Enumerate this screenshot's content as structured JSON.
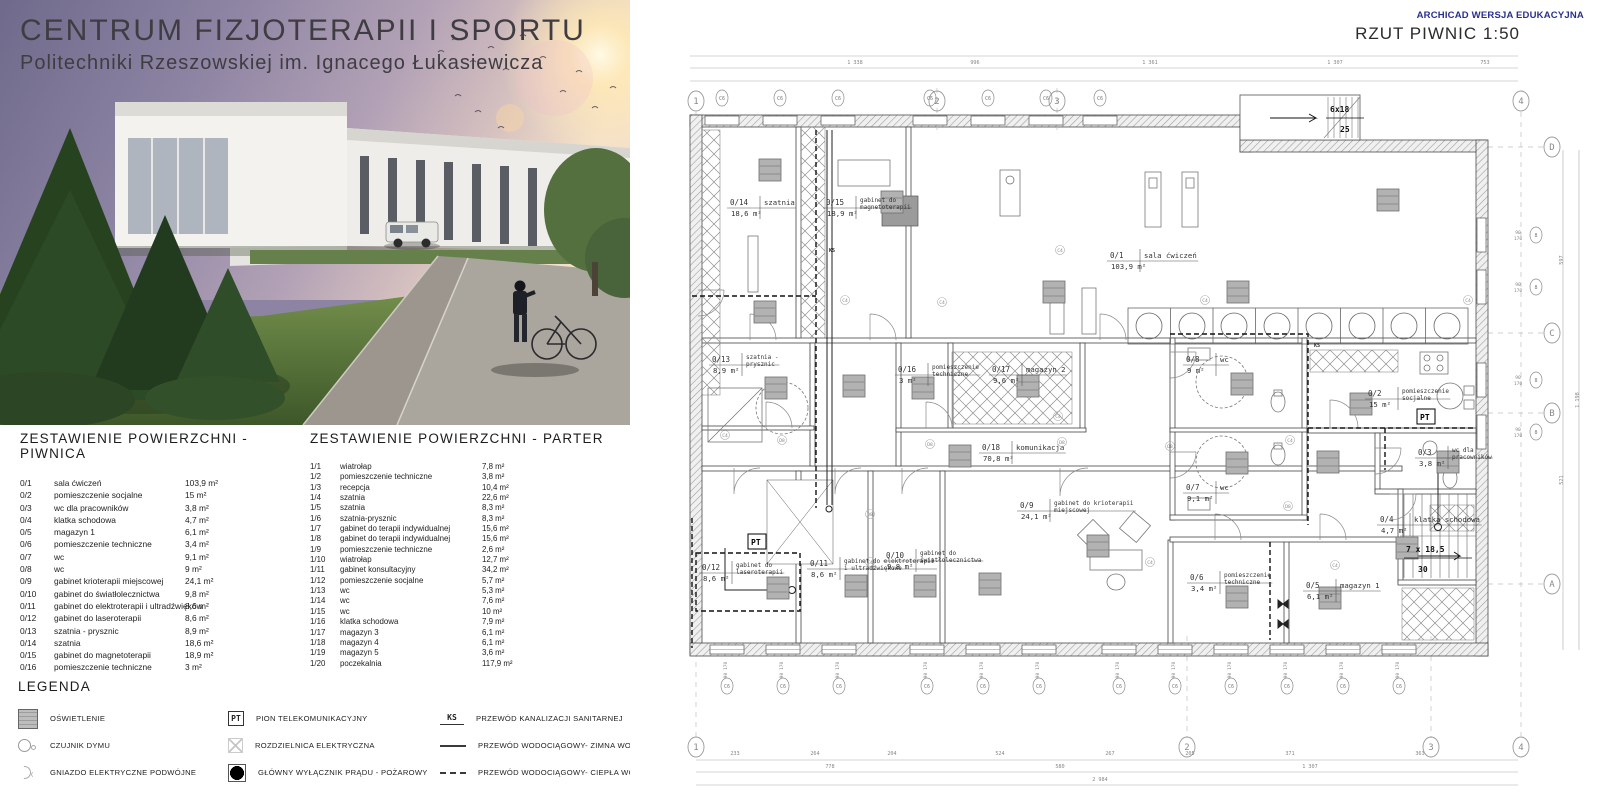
{
  "header": {
    "title_line1": "CENTRUM  FIZJOTERAPII I SPORTU",
    "title_line2": "Politechniki Rzeszowskiej im. Ignacego Łukasiewicza"
  },
  "tables": {
    "piwnica": {
      "title": "ZESTAWIENIE POWIERZCHNI - PIWNICA",
      "rows": [
        {
          "id": "0/1",
          "name": "sala ćwiczeń",
          "area": "103,9 m²"
        },
        {
          "id": "0/2",
          "name": "pomieszczenie socjalne",
          "area": "15 m²"
        },
        {
          "id": "0/3",
          "name": "wc dla pracowników",
          "area": "3,8 m²"
        },
        {
          "id": "0/4",
          "name": "klatka schodowa",
          "area": "4,7 m²"
        },
        {
          "id": "0/5",
          "name": "magazyn 1",
          "area": "6,1 m²"
        },
        {
          "id": "0/6",
          "name": "pomieszczenie techniczne",
          "area": "3,4 m²"
        },
        {
          "id": "0/7",
          "name": "wc",
          "area": "9,1 m²"
        },
        {
          "id": "0/8",
          "name": "wc",
          "area": "9 m²"
        },
        {
          "id": "0/9",
          "name": "gabinet krioterapii miejscowej",
          "area": "24,1 m²"
        },
        {
          "id": "0/10",
          "name": "gabinet do światłolecznictwa",
          "area": "9,8 m²"
        },
        {
          "id": "0/11",
          "name": "gabinet do elektroterapii i ultradźwięków",
          "area": "8,6 m²"
        },
        {
          "id": "0/12",
          "name": "gabinet do laseroterapii",
          "area": "8,6 m²"
        },
        {
          "id": "0/13",
          "name": "szatnia - prysznic",
          "area": "8,9 m²"
        },
        {
          "id": "0/14",
          "name": "szatnia",
          "area": "18,6 m²"
        },
        {
          "id": "0/15",
          "name": "gabinet do magnetoterapii",
          "area": "18,9 m²"
        },
        {
          "id": "0/16",
          "name": "pomieszczenie techniczne",
          "area": "3 m²"
        },
        {
          "id": "0/17",
          "name": "magazyn",
          "area": "9,6 m²"
        }
      ]
    },
    "parter": {
      "title": "ZESTAWIENIE POWIERZCHNI - PARTER",
      "rows": [
        {
          "id": "1/1",
          "name": "wiatrołap",
          "area": "7,8 m²"
        },
        {
          "id": "1/2",
          "name": "pomieszczenie techniczne",
          "area": "3,8 m²"
        },
        {
          "id": "1/3",
          "name": "recepcja",
          "area": "10,4 m²"
        },
        {
          "id": "1/4",
          "name": "szatnia",
          "area": "22,6 m²"
        },
        {
          "id": "1/5",
          "name": "szatnia",
          "area": "8,3 m²"
        },
        {
          "id": "1/6",
          "name": "szatnia-prysznic",
          "area": "8,3 m²"
        },
        {
          "id": "1/7",
          "name": "gabinet do terapii indywidualnej",
          "area": "15,6 m²"
        },
        {
          "id": "1/8",
          "name": "gabinet do terapii indywidualnej",
          "area": "15,6 m²"
        },
        {
          "id": "1/9",
          "name": "pomieszczenie techniczne",
          "area": "2,6 m²"
        },
        {
          "id": "1/10",
          "name": "wiatrołap",
          "area": "12,7 m²"
        },
        {
          "id": "1/11",
          "name": "gabinet konsultacyjny",
          "area": "34,2 m²"
        },
        {
          "id": "1/12",
          "name": "pomieszczenie socjalne",
          "area": "5,7 m²"
        },
        {
          "id": "1/13",
          "name": "wc",
          "area": "5,3 m²"
        },
        {
          "id": "1/14",
          "name": "wc",
          "area": "7,6 m²"
        },
        {
          "id": "1/15",
          "name": "wc",
          "area": "10 m²"
        },
        {
          "id": "1/16",
          "name": "klatka schodowa",
          "area": "7,9 m²"
        },
        {
          "id": "1/17",
          "name": "magazyn 3",
          "area": "6,1 m²"
        },
        {
          "id": "1/18",
          "name": "magazyn 4",
          "area": "6,1 m²"
        },
        {
          "id": "1/19",
          "name": "magazyn 5",
          "area": "3,6 m²"
        },
        {
          "id": "1/20",
          "name": "poczekalnia",
          "area": "117,9 m²"
        }
      ]
    }
  },
  "legend": {
    "title": "LEGENDA",
    "col1": [
      {
        "icon": "lighting-icon",
        "badge": "",
        "label": "OŚWIETLENIE"
      },
      {
        "icon": "smoke-icon",
        "badge": "",
        "label": "CZUJNIK DYMU"
      },
      {
        "icon": "socket-icon",
        "badge": "",
        "label": "GNIAZDO ELEKTRYCZNE PODWÓJNE"
      }
    ],
    "col2": [
      {
        "icon": "pt-icon",
        "badge": "PT",
        "label": "PION TELEKOMUNIKACYJNY"
      },
      {
        "icon": "switchboard-icon",
        "badge": "",
        "label": "ROZDZIELNICA ELEKTRYCZNA"
      },
      {
        "icon": "mainswitch-icon",
        "badge": "",
        "label": "GŁÓWNY WYŁĄCZNIK PRĄDU - POŻAROWY"
      }
    ],
    "col3": [
      {
        "icon": "ks-icon",
        "badge": "KS",
        "label": "PRZEWÓD KANALIZACJI SANITARNEJ"
      },
      {
        "icon": "solidline-icon",
        "badge": "",
        "label": "PRZEWÓD WODOCIĄGOWY- ZIMNA WODA"
      },
      {
        "icon": "dashedline-icon",
        "badge": "",
        "label": "PRZEWÓD WODOCIĄGOWY- CIEPŁA WODA"
      }
    ]
  },
  "plan": {
    "watermark": "ARCHICAD WERSJA EDUKACYJNA",
    "title": "RZUT PIWNIC 1:50",
    "accent_color": "#29308c",
    "rooms": [
      {
        "id": "0/14",
        "name": "szatnia",
        "area": "18,6 m²",
        "x": 100,
        "y": 205
      },
      {
        "id": "0/15",
        "name": "gabinet do magnetoterapii",
        "area": "18,9 m²",
        "x": 196,
        "y": 205
      },
      {
        "id": "0/1",
        "name": "sala ćwiczeń",
        "area": "103,9 m²",
        "x": 480,
        "y": 258
      },
      {
        "id": "0/13",
        "name": "szatnia - prysznic",
        "area": "8,9 m²",
        "x": 82,
        "y": 362
      },
      {
        "id": "0/16",
        "name": "pomieszczenie techniczne",
        "area": "3 m²",
        "x": 268,
        "y": 372
      },
      {
        "id": "0/17",
        "name": "magazyn 2",
        "area": "9,6 m²",
        "x": 362,
        "y": 372
      },
      {
        "id": "0/8",
        "name": "wc",
        "area": "9 m²",
        "x": 556,
        "y": 362
      },
      {
        "id": "0/2",
        "name": "pomieszczenie socjalne",
        "area": "15 m²",
        "x": 738,
        "y": 396
      },
      {
        "id": "0/18",
        "name": "komunikacja",
        "area": "70,8 m²",
        "x": 352,
        "y": 450
      },
      {
        "id": "0/3",
        "name": "wc dla pracowników",
        "area": "3,8 m²",
        "x": 788,
        "y": 455
      },
      {
        "id": "0/9",
        "name": "gabinet do krioterapii miejscowej",
        "area": "24,1 m²",
        "x": 390,
        "y": 508
      },
      {
        "id": "0/7",
        "name": "wc",
        "area": "9,1 m²",
        "x": 556,
        "y": 490
      },
      {
        "id": "0/4",
        "name": "klatka schodowa",
        "area": "4,7 m²",
        "x": 750,
        "y": 522
      },
      {
        "id": "0/12",
        "name": "gabinet do laseroterapii",
        "area": "8,6 m²",
        "x": 72,
        "y": 570
      },
      {
        "id": "0/11",
        "name": "gabinet do elektroterapii i ultradźwiękowe",
        "area": "8,6 m²",
        "x": 180,
        "y": 566
      },
      {
        "id": "0/10",
        "name": "gabinet do światłolecznictwa",
        "area": "9,8 m²",
        "x": 256,
        "y": 558
      },
      {
        "id": "0/6",
        "name": "pomieszczenie techniczne",
        "area": "3,4 m²",
        "x": 560,
        "y": 580
      },
      {
        "id": "0/5",
        "name": "magazyn 1",
        "area": "6,1 m²",
        "x": 676,
        "y": 588
      }
    ],
    "grid_top": [
      {
        "label": "1",
        "x": 66
      },
      {
        "label": "2",
        "x": 307
      },
      {
        "label": "3",
        "x": 427
      },
      {
        "label": "4",
        "x": 891
      }
    ],
    "grid_bottom": [
      {
        "label": "1",
        "x": 66
      },
      {
        "label": "2",
        "x": 557
      },
      {
        "label": "3",
        "x": 801
      },
      {
        "label": "4",
        "x": 891
      }
    ],
    "grid_right": [
      {
        "label": "D",
        "y": 147
      },
      {
        "label": "C",
        "y": 333
      },
      {
        "label": "B",
        "y": 413
      },
      {
        "label": "A",
        "y": 584
      }
    ],
    "stair_top": {
      "line1": "6x18",
      "line2": "25"
    },
    "stair_right": {
      "line1": "7 x 18,5",
      "line2": "30"
    },
    "pt_label": "PT",
    "pt_positions": [
      [
        120,
        545
      ],
      [
        789,
        420
      ]
    ],
    "ks_label": "KS",
    "ks_positions": [
      [
        199,
        252
      ],
      [
        684,
        347
      ]
    ],
    "window_marker": {
      "label": "C6",
      "dim_top": "90",
      "dim_bottom": "170"
    },
    "right_marker_label": "8",
    "windows_bottom_x": [
      97,
      153,
      209,
      297,
      353,
      409,
      489,
      545,
      601,
      657,
      713,
      769
    ],
    "windows_top_x": [
      92,
      150,
      208,
      300,
      358,
      416,
      470
    ],
    "windows_right_y": [
      235,
      287,
      380,
      432
    ],
    "dims": [
      {
        "orient": "h",
        "y": 66,
        "items": [
          {
            "v": "1 338",
            "x": 225
          },
          {
            "v": "996",
            "x": 345
          },
          {
            "v": "1 361",
            "x": 520
          },
          {
            "v": "1 307",
            "x": 705
          },
          {
            "v": "753",
            "x": 855
          }
        ]
      },
      {
        "orient": "h",
        "y": 757,
        "items": [
          {
            "v": "233",
            "x": 105
          },
          {
            "v": "264",
            "x": 185
          },
          {
            "v": "204",
            "x": 262
          },
          {
            "v": "524",
            "x": 370
          },
          {
            "v": "267",
            "x": 480
          },
          {
            "v": "205",
            "x": 560
          },
          {
            "v": "371",
            "x": 660
          },
          {
            "v": "363",
            "x": 790
          }
        ]
      },
      {
        "orient": "h",
        "y": 770,
        "items": [
          {
            "v": "778",
            "x": 200
          },
          {
            "v": "580",
            "x": 430
          },
          {
            "v": "1 307",
            "x": 680
          }
        ]
      },
      {
        "orient": "h",
        "y": 783,
        "items": [
          {
            "v": "2 984",
            "x": 470
          }
        ]
      },
      {
        "orient": "v",
        "x": 933,
        "items": [
          {
            "v": "597",
            "y": 260
          },
          {
            "v": "521",
            "y": 480
          }
        ]
      },
      {
        "orient": "v",
        "x": 949,
        "items": [
          {
            "v": "1 198",
            "y": 400
          }
        ]
      }
    ],
    "marks": [
      {
        "label": "C4",
        "pts": [
          [
            215,
            300
          ],
          [
            575,
            300
          ],
          [
            312,
            302
          ],
          [
            660,
            440
          ],
          [
            428,
            416
          ],
          [
            240,
            562
          ],
          [
            520,
            562
          ],
          [
            705,
            565
          ],
          [
            95,
            435
          ],
          [
            838,
            300
          ],
          [
            430,
            250
          ]
        ]
      },
      {
        "label": "D8",
        "pts": [
          [
            152,
            440
          ],
          [
            300,
            444
          ],
          [
            432,
            442
          ],
          [
            540,
            446
          ],
          [
            240,
            514
          ],
          [
            658,
            506
          ]
        ]
      }
    ],
    "lighting": [
      [
        140,
        170
      ],
      [
        262,
        202
      ],
      [
        424,
        292
      ],
      [
        608,
        292
      ],
      [
        758,
        200
      ],
      [
        135,
        312
      ],
      [
        146,
        388
      ],
      [
        224,
        386
      ],
      [
        293,
        388
      ],
      [
        398,
        386
      ],
      [
        330,
        456
      ],
      [
        612,
        384
      ],
      [
        731,
        404
      ],
      [
        607,
        463
      ],
      [
        698,
        462
      ],
      [
        818,
        462
      ],
      [
        148,
        588
      ],
      [
        226,
        586
      ],
      [
        295,
        586
      ],
      [
        360,
        584
      ],
      [
        468,
        546
      ],
      [
        607,
        597
      ],
      [
        700,
        598
      ],
      [
        777,
        548
      ]
    ]
  }
}
